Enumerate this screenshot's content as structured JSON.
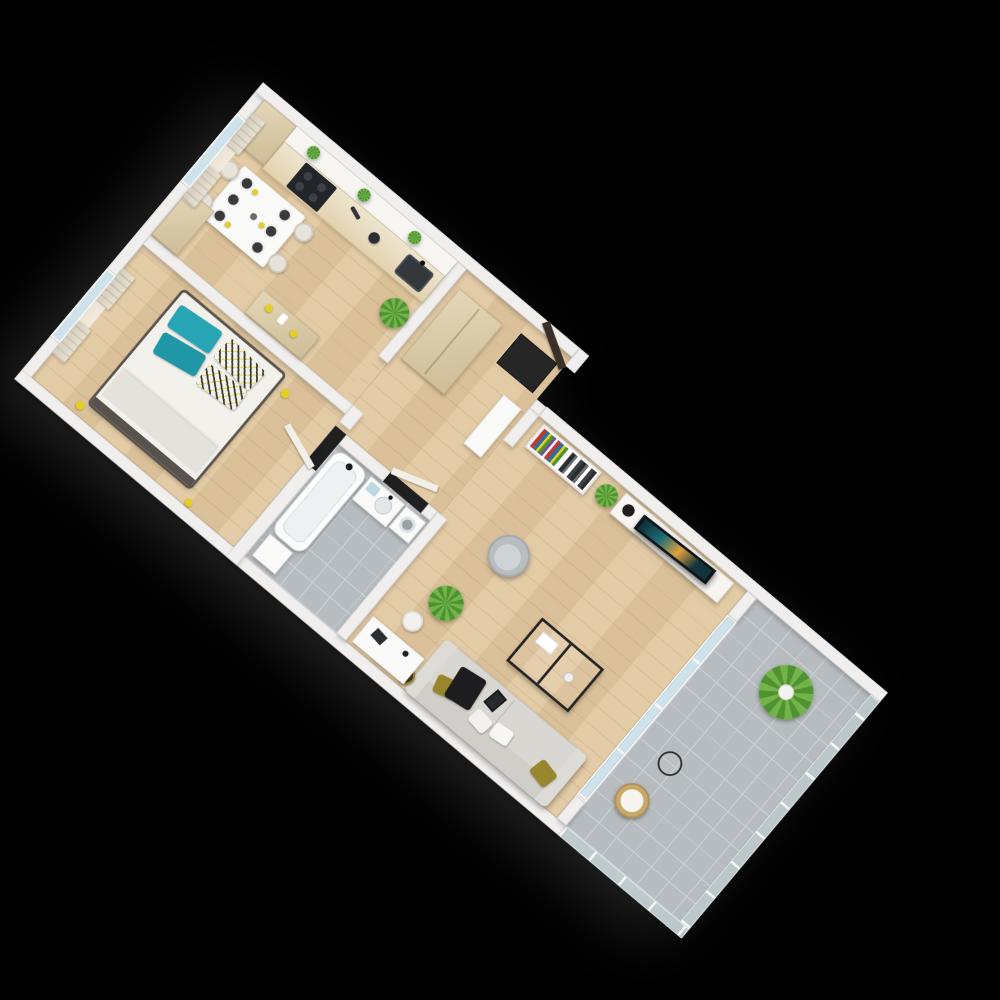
{
  "scene": {
    "type": "isometric-3d-floor-plan-render",
    "background": "#000000",
    "plan_rotation_deg": 40,
    "text_visible_on_image": "none"
  },
  "colors": {
    "bg": "#000000",
    "wall": "#f0efee",
    "wallShade": "#d8d8d6",
    "floorWood": "#e1c79f",
    "bathFloor": "#b6bcc0",
    "tileLine": "#cdd2d5",
    "glass": "#cde2ea",
    "curtain": "#d5cebf",
    "beige": "#e4d6b8",
    "beigeDark": "#cdbd97",
    "applianceDark": "#22252a",
    "doorDark": "#3a3027",
    "mat": "#262626",
    "teal": "#27a5b4",
    "tealDark": "#1f97a6",
    "yellow": "#e5ce22",
    "olive": "#97862c",
    "sofa": "#d8d7d2",
    "armchair": "#b7bdc1",
    "plantGreen": "#4f9330",
    "plantGreenLight": "#72b34a",
    "white": "#fafaf8",
    "tvDark": "#101318"
  },
  "rooms": [
    {
      "id": "kitchen-dining",
      "items": [
        "tall-corner-cabinet",
        "upper-shelf-with-3-plants",
        "kitchen-counter",
        "cooktop-oven",
        "kettle",
        "sink",
        "corner-plant",
        "dining-table",
        "4-chairs",
        "6-plates-with-yellow-napkins",
        "wardrobe",
        "dresser-with-yellow-decor",
        "window-with-curtains"
      ]
    },
    {
      "id": "bedroom",
      "items": [
        "double-bed",
        "2-teal-pillows",
        "2-patterned-pillows",
        "folded-blanket",
        "dark-bed-frame",
        "yellow-slippers",
        "window-with-curtains",
        "door-to-hall"
      ]
    },
    {
      "id": "hallway",
      "items": [
        "freestanding-tall-cabinet",
        "slim-white-cabinet",
        "entry-door-open-dark",
        "black-doormat"
      ]
    },
    {
      "id": "bathroom",
      "items": [
        "bathtub",
        "vanity-with-sink",
        "light-blue-towels",
        "washing-machine",
        "white-storage-box",
        "gray-tile-floor",
        "door-to-hall"
      ]
    },
    {
      "id": "living-room",
      "items": [
        "bookshelf-with-colorful-books",
        "snake-plant",
        "tv-cabinet",
        "flat-tv",
        "round-speaker",
        "radiator",
        "armchair-gray",
        "black-metal-coffee-table",
        "sofa-with-olive-and-white-pillows",
        "tablet-on-sofa",
        "black-throw",
        "gold-side-table",
        "palm-floor-plant",
        "desk",
        "desk-chair",
        "laptop"
      ]
    },
    {
      "id": "balcony",
      "items": [
        "gray-tile-floor",
        "glass-balustrade",
        "sliding-glass-door",
        "large-palm-plant",
        "wire-side-table",
        "rattan-chair-with-cushion"
      ]
    }
  ]
}
